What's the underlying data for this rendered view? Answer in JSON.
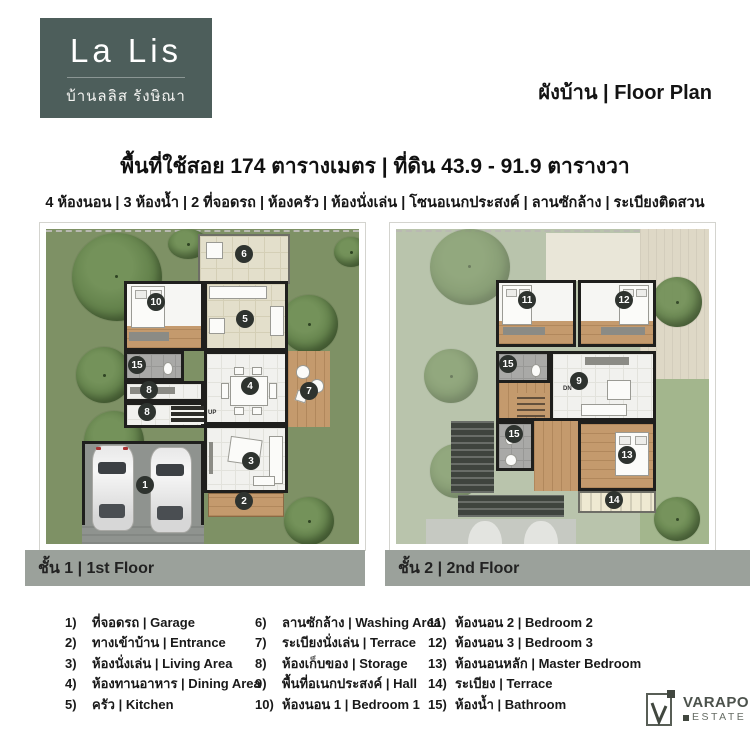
{
  "header": {
    "logo_title": "La Lis",
    "logo_subtitle": "บ้านลลิส รังษิณา",
    "page_label": "ผังบ้าน | Floor Plan"
  },
  "title": "พื้นที่ใช้สอย 174 ตารางเมตร | ที่ดิน 43.9 - 91.9 ตารางวา",
  "subtitle": "4 ห้องนอน | 3 ห้องน้ำ | 2 ที่จอดรถ | ห้องครัว | ห้องนั่งเล่น | โซนอเนกประสงค์ | ลานซักล้าง | ระเบียงติดสวน",
  "floors": [
    {
      "label": "ชั้น 1 | 1st Floor",
      "stair_label": "UP",
      "badges": [
        {
          "n": "6",
          "x": 198,
          "y": 25
        },
        {
          "n": "10",
          "x": 110,
          "y": 73
        },
        {
          "n": "5",
          "x": 199,
          "y": 90
        },
        {
          "n": "15",
          "x": 91,
          "y": 136
        },
        {
          "n": "8",
          "x": 103,
          "y": 161
        },
        {
          "n": "8",
          "x": 101,
          "y": 183
        },
        {
          "n": "4",
          "x": 204,
          "y": 157
        },
        {
          "n": "7",
          "x": 263,
          "y": 162
        },
        {
          "n": "3",
          "x": 205,
          "y": 232
        },
        {
          "n": "2",
          "x": 198,
          "y": 272
        },
        {
          "n": "1",
          "x": 99,
          "y": 256
        }
      ]
    },
    {
      "label": "ชั้น 2 | 2nd Floor",
      "stair_label": "DN",
      "badges": [
        {
          "n": "11",
          "x": 131,
          "y": 71
        },
        {
          "n": "12",
          "x": 228,
          "y": 71
        },
        {
          "n": "15",
          "x": 112,
          "y": 135
        },
        {
          "n": "9",
          "x": 183,
          "y": 152
        },
        {
          "n": "15",
          "x": 118,
          "y": 205
        },
        {
          "n": "13",
          "x": 231,
          "y": 226
        },
        {
          "n": "14",
          "x": 218,
          "y": 271
        }
      ]
    }
  ],
  "legend": {
    "columns": [
      [
        {
          "num": "1)",
          "text": "ที่จอดรถ | Garage"
        },
        {
          "num": "2)",
          "text": "ทางเข้าบ้าน | Entrance"
        },
        {
          "num": "3)",
          "text": "ห้องนั่งเล่น | Living Area"
        },
        {
          "num": "4)",
          "text": "ห้องทานอาหาร | Dining Area"
        },
        {
          "num": "5)",
          "text": "ครัว | Kitchen"
        }
      ],
      [
        {
          "num": "6)",
          "text": "ลานซักล้าง | Washing Area"
        },
        {
          "num": "7)",
          "text": "ระเบียงนั่งเล่น | Terrace"
        },
        {
          "num": "8)",
          "text": "ห้องเก็บของ | Storage"
        },
        {
          "num": "9)",
          "text": "พื้นที่อเนกประสงค์ | Hall"
        },
        {
          "num": "10)",
          "text": "ห้องนอน 1 | Bedroom 1"
        }
      ],
      [
        {
          "num": "11)",
          "text": "ห้องนอน 2 | Bedroom 2"
        },
        {
          "num": "12)",
          "text": "ห้องนอน 3 | Bedroom 3"
        },
        {
          "num": "13)",
          "text": "ห้องนอนหลัก | Master Bedroom"
        },
        {
          "num": "14)",
          "text": "ระเบียง | Terrace"
        },
        {
          "num": "15)",
          "text": "ห้องน้ำ | Bathroom"
        }
      ]
    ]
  },
  "brand": {
    "name": "VARAPOL",
    "type": "ESTATE"
  },
  "colors": {
    "logo-bg": "#4d5e5b",
    "bar": "#9ba19b",
    "badge": "#2e332f",
    "wall": "#1f1f1d",
    "grass": "#7e9165",
    "grass-faded": "#b9c4ac",
    "tile": "#f1f1ee",
    "beige": "#e3dfcb",
    "wood": "#c49a6d",
    "bath": "#a9a9a7",
    "slab": "#8f938f",
    "deck-pale": "#ded8c6",
    "roof": "#3f443e"
  }
}
